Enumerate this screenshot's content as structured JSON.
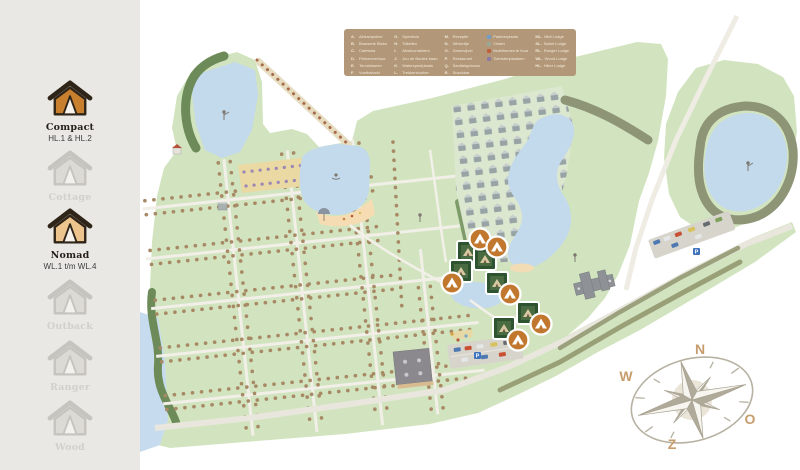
{
  "sidebar": {
    "items": [
      {
        "label": "Compact",
        "code": "HL.1 & HL.2",
        "active": true
      },
      {
        "label": "Cottage",
        "code": "",
        "active": false
      },
      {
        "label": "Nomad",
        "code": "WL.1 t/m WL.4",
        "active": true
      },
      {
        "label": "Outback",
        "code": "",
        "active": false
      },
      {
        "label": "Ranger",
        "code": "",
        "active": false
      },
      {
        "label": "Wood",
        "code": "",
        "active": false
      }
    ]
  },
  "legend": {
    "columns": [
      {
        "items": [
          {
            "key": "A.",
            "label": "Airtrampoline"
          },
          {
            "key": "B.",
            "label": "Brasserie Bistro"
          },
          {
            "key": "C.",
            "label": "Cafetaria"
          },
          {
            "key": "D.",
            "label": "Fietsenverhuur"
          },
          {
            "key": "E.",
            "label": "Tennisbanen"
          },
          {
            "key": "F.",
            "label": "Voetbalveld"
          }
        ]
      },
      {
        "items": [
          {
            "key": "G.",
            "label": "Speeltuin"
          },
          {
            "key": "H.",
            "label": "Toiletten"
          },
          {
            "key": "I.",
            "label": "Afvalcontainers"
          },
          {
            "key": "J.",
            "label": "Jeu de Boules baan"
          },
          {
            "key": "K.",
            "label": "Waterspeelplaats"
          },
          {
            "key": "L.",
            "label": "Trekkershutten"
          }
        ]
      },
      {
        "items": [
          {
            "key": "M.",
            "label": "Receptie"
          },
          {
            "key": "N.",
            "label": "Winkeltje"
          },
          {
            "key": "O.",
            "label": "Zwemvijver"
          },
          {
            "key": "P.",
            "label": "Restaurant"
          },
          {
            "key": "Q.",
            "label": "Sanitairgebouw"
          },
          {
            "key": "R.",
            "label": "Snackbar"
          }
        ]
      },
      {
        "items": [
          {
            "color": "#6f9bc7",
            "label": "Parkeerplaats"
          },
          {
            "color": "#9aa896",
            "label": "Chalet"
          },
          {
            "color": "#bf5f3b",
            "label": "Mobilhomes te huur"
          },
          {
            "color": "#8b7aa6",
            "label": "Toeristenplaatsen"
          }
        ]
      },
      {
        "items": [
          {
            "key": "ML.",
            "label": "Mini Lodge"
          },
          {
            "key": "SL.",
            "label": "Safari Lodge"
          },
          {
            "key": "RL.",
            "label": "Ranger Lodge"
          },
          {
            "key": "WL.",
            "label": "Wood Lodge"
          },
          {
            "key": "HL.",
            "label": "Hiker Lodge"
          }
        ]
      }
    ]
  },
  "compass": {
    "north": "N",
    "east": "O",
    "south": "Z",
    "west": "W"
  },
  "map": {
    "parking_sign": "P",
    "marker_pairs": 6,
    "marker_pin_color": "#c1782e",
    "marker_photo_frame_color": "#2d5331"
  },
  "colors": {
    "sidebar_bg": "#e9e8e4",
    "legend_bg": "#b29878",
    "park_green": "#d2e4bf",
    "water": "#c3d9ec",
    "sand": "#f6dcb2",
    "tree_dark": "#6d8b58",
    "hedge_olive": "#8e9476",
    "tree_dot": "#a78a65",
    "road": "#e9e6dd",
    "compass_letter": "#c79c6b",
    "active_tent": "#c8802f",
    "active_tent_2": "#edc38e"
  }
}
